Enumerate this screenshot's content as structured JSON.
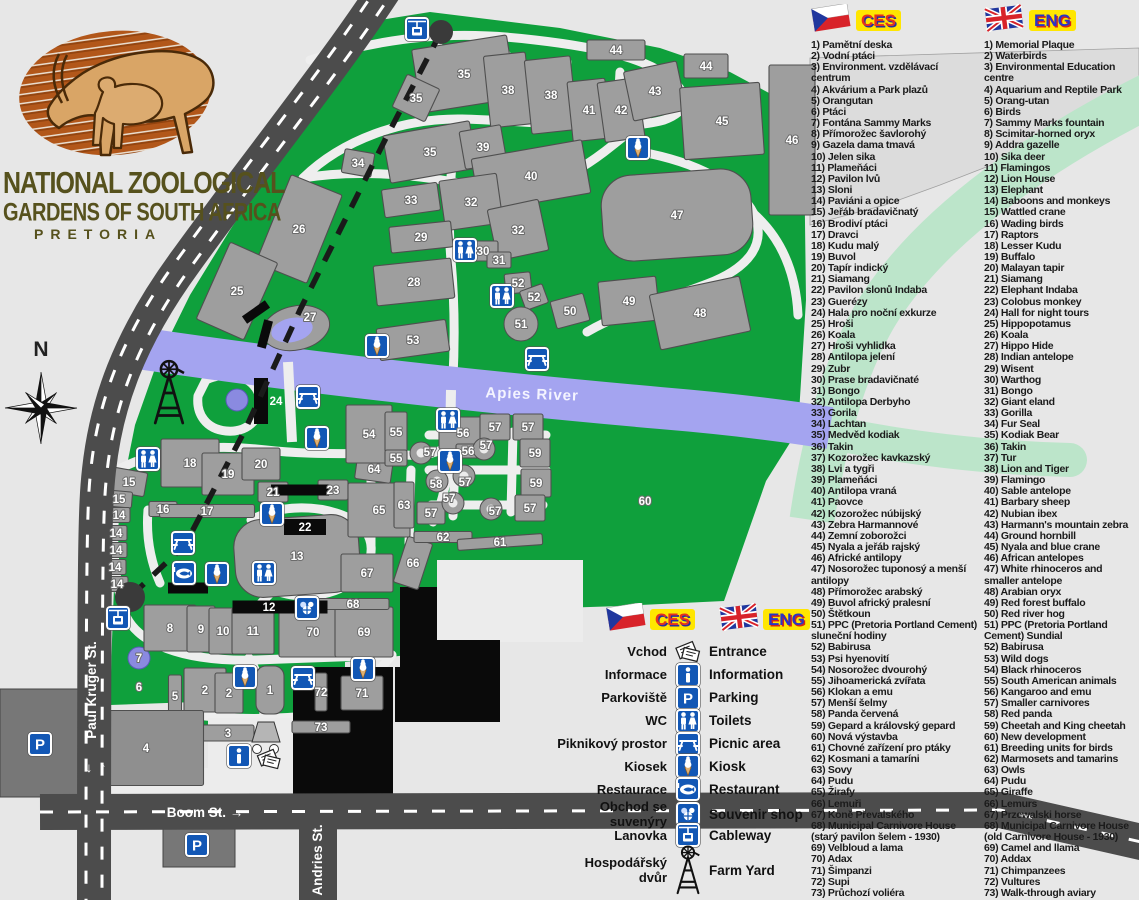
{
  "title": {
    "line1": "NATIONAL ZOOLOGICAL",
    "line2": "GARDENS OF SOUTH AFRICA",
    "line3": "PRETORIA"
  },
  "compass": {
    "label": "N"
  },
  "map": {
    "river_label": "Apies River",
    "streets": {
      "paul_kruger": "Paul Kruger St.",
      "boom": "Boom St. →",
      "andries": "Andries St.",
      "arrow_down": "↓",
      "arrow_up": "↑"
    },
    "regions": [
      {
        "n": "44",
        "x": 616,
        "y": 50,
        "w": 58,
        "h": 20
      },
      {
        "n": "44",
        "x": 706,
        "y": 66,
        "w": 44,
        "h": 24
      },
      {
        "n": "35",
        "x": 464,
        "y": 74,
        "w": 96,
        "h": 64,
        "r": -9
      },
      {
        "n": "38",
        "x": 508,
        "y": 90,
        "w": 42,
        "h": 72,
        "r": -6
      },
      {
        "n": "38",
        "x": 551,
        "y": 95,
        "w": 46,
        "h": 74,
        "r": -6
      },
      {
        "n": "41",
        "x": 589,
        "y": 110,
        "w": 38,
        "h": 60,
        "r": -6
      },
      {
        "n": "42",
        "x": 621,
        "y": 110,
        "w": 40,
        "h": 60,
        "r": -8
      },
      {
        "n": "43",
        "x": 655,
        "y": 91,
        "w": 54,
        "h": 50,
        "r": -12
      },
      {
        "n": "45",
        "x": 722,
        "y": 121,
        "w": 80,
        "h": 72,
        "r": -4
      },
      {
        "n": "46",
        "x": 792,
        "y": 140,
        "w": 46,
        "h": 150
      },
      {
        "n": "35",
        "x": 416,
        "y": 98,
        "w": 36,
        "h": 36,
        "r": 25
      },
      {
        "n": "34",
        "x": 358,
        "y": 163,
        "w": 30,
        "h": 24,
        "r": 10
      },
      {
        "n": "35",
        "x": 430,
        "y": 152,
        "w": 88,
        "h": 48,
        "r": -10
      },
      {
        "n": "39",
        "x": 483,
        "y": 147,
        "w": 42,
        "h": 38,
        "r": -10
      },
      {
        "n": "40",
        "x": 531,
        "y": 176,
        "w": 112,
        "h": 54,
        "r": -10
      },
      {
        "n": "33",
        "x": 411,
        "y": 200,
        "w": 56,
        "h": 28,
        "r": -8
      },
      {
        "n": "32",
        "x": 471,
        "y": 202,
        "w": 58,
        "h": 50,
        "r": -8
      },
      {
        "n": "32",
        "x": 518,
        "y": 230,
        "w": 52,
        "h": 52,
        "r": -12
      },
      {
        "n": "26",
        "x": 299,
        "y": 229,
        "w": 55,
        "h": 95,
        "r": 22
      },
      {
        "n": "29",
        "x": 421,
        "y": 237,
        "w": 62,
        "h": 26,
        "r": -6
      },
      {
        "n": "30",
        "x": 483,
        "y": 251,
        "w": 30,
        "h": 20
      },
      {
        "n": "31",
        "x": 499,
        "y": 260,
        "w": 24,
        "h": 16
      },
      {
        "n": "25",
        "x": 237,
        "y": 291,
        "w": 52,
        "h": 84,
        "r": 24
      },
      {
        "n": "28",
        "x": 414,
        "y": 282,
        "w": 78,
        "h": 40,
        "r": -6
      },
      {
        "n": "52",
        "x": 518,
        "y": 283,
        "w": 26,
        "h": 20,
        "r": -6
      },
      {
        "n": "52",
        "x": 534,
        "y": 297,
        "w": 24,
        "h": 20,
        "r": -20
      },
      {
        "n": "50",
        "x": 570,
        "y": 311,
        "w": 34,
        "h": 28,
        "r": -15
      },
      {
        "n": "49",
        "x": 629,
        "y": 301,
        "w": 58,
        "h": 44,
        "r": -6
      },
      {
        "n": "48",
        "x": 700,
        "y": 313,
        "w": 92,
        "h": 56,
        "r": -12
      },
      {
        "n": "47",
        "x": 677,
        "y": 215,
        "w": 150,
        "h": 86,
        "r": -4,
        "s": "blob"
      },
      {
        "n": "53",
        "x": 413,
        "y": 340,
        "w": 70,
        "h": 32,
        "r": -8
      },
      {
        "n": "18",
        "x": 190,
        "y": 463,
        "w": 58,
        "h": 48
      },
      {
        "n": "19",
        "x": 228,
        "y": 474,
        "w": 52,
        "h": 42
      },
      {
        "n": "20",
        "x": 261,
        "y": 464,
        "w": 38,
        "h": 32
      },
      {
        "n": "15",
        "x": 129,
        "y": 482,
        "w": 34,
        "h": 24,
        "r": 10
      },
      {
        "n": "15",
        "x": 119,
        "y": 499,
        "w": 26,
        "h": 16,
        "r": 5
      },
      {
        "n": "16",
        "x": 163,
        "y": 509,
        "w": 28,
        "h": 15
      },
      {
        "n": "17",
        "x": 207,
        "y": 511,
        "w": 95,
        "h": 13
      },
      {
        "n": "14",
        "x": 119,
        "y": 515,
        "w": 22,
        "h": 15
      },
      {
        "n": "14",
        "x": 116,
        "y": 533,
        "w": 22,
        "h": 15
      },
      {
        "n": "14",
        "x": 116,
        "y": 550,
        "w": 22,
        "h": 15
      },
      {
        "n": "14",
        "x": 115,
        "y": 567,
        "w": 22,
        "h": 15
      },
      {
        "n": "14",
        "x": 117,
        "y": 584,
        "w": 22,
        "h": 15
      },
      {
        "n": "21",
        "x": 273,
        "y": 492,
        "w": 30,
        "h": 20
      },
      {
        "n": "23",
        "x": 333,
        "y": 490,
        "w": 30,
        "h": 20
      },
      {
        "n": "13",
        "x": 297,
        "y": 556,
        "w": 125,
        "h": 78,
        "r": -4,
        "s": "blob"
      },
      {
        "n": "8",
        "x": 170,
        "y": 628,
        "w": 52,
        "h": 46
      },
      {
        "n": "9",
        "x": 201,
        "y": 629,
        "w": 28,
        "h": 46
      },
      {
        "n": "10",
        "x": 223,
        "y": 631,
        "w": 28,
        "h": 46
      },
      {
        "n": "11",
        "x": 253,
        "y": 631,
        "w": 42,
        "h": 46
      },
      {
        "n": "70",
        "x": 313,
        "y": 632,
        "w": 68,
        "h": 50
      },
      {
        "n": "69",
        "x": 364,
        "y": 632,
        "w": 58,
        "h": 50
      },
      {
        "n": "68",
        "x": 353,
        "y": 604,
        "w": 72,
        "h": 11
      },
      {
        "n": "67",
        "x": 367,
        "y": 573,
        "w": 52,
        "h": 38
      },
      {
        "n": "66",
        "x": 413,
        "y": 563,
        "w": 26,
        "h": 48,
        "r": 18
      },
      {
        "n": "65",
        "x": 379,
        "y": 510,
        "w": 62,
        "h": 54
      },
      {
        "n": "63",
        "x": 404,
        "y": 505,
        "w": 20,
        "h": 46
      },
      {
        "n": "64",
        "x": 374,
        "y": 469,
        "w": 36,
        "h": 24,
        "r": 8
      },
      {
        "n": "62",
        "x": 443,
        "y": 537,
        "w": 58,
        "h": 11
      },
      {
        "n": "61",
        "x": 500,
        "y": 542,
        "w": 85,
        "h": 11,
        "r": -4
      },
      {
        "n": "54",
        "x": 369,
        "y": 434,
        "w": 46,
        "h": 58
      },
      {
        "n": "55",
        "x": 396,
        "y": 432,
        "w": 22,
        "h": 40
      },
      {
        "n": "55",
        "x": 396,
        "y": 458,
        "w": 22,
        "h": 16
      },
      {
        "n": "56",
        "x": 463,
        "y": 433,
        "w": 48,
        "h": 32
      },
      {
        "n": "56",
        "x": 468,
        "y": 451,
        "w": 24,
        "h": 14
      },
      {
        "n": "57",
        "x": 495,
        "y": 427,
        "w": 30,
        "h": 26
      },
      {
        "n": "57",
        "x": 528,
        "y": 427,
        "w": 30,
        "h": 26
      },
      {
        "n": "59",
        "x": 535,
        "y": 453,
        "w": 30,
        "h": 28
      },
      {
        "n": "59",
        "x": 536,
        "y": 483,
        "w": 30,
        "h": 28
      },
      {
        "n": "57",
        "x": 431,
        "y": 513,
        "w": 28,
        "h": 22
      },
      {
        "n": "57",
        "x": 530,
        "y": 508,
        "w": 30,
        "h": 26
      },
      {
        "n": "71",
        "x": 362,
        "y": 693,
        "w": 42,
        "h": 34
      },
      {
        "n": "72",
        "x": 321,
        "y": 692,
        "w": 12,
        "h": 38
      },
      {
        "n": "73",
        "x": 321,
        "y": 727,
        "w": 58,
        "h": 12
      },
      {
        "n": "1",
        "x": 270,
        "y": 690,
        "w": 28,
        "h": 48,
        "s": "blob"
      },
      {
        "n": "2",
        "x": 205,
        "y": 690,
        "w": 42,
        "h": 44
      },
      {
        "n": "2",
        "x": 229,
        "y": 693,
        "w": 28,
        "h": 40
      },
      {
        "n": "3",
        "x": 228,
        "y": 733,
        "w": 52,
        "h": 16
      },
      {
        "n": "5",
        "x": 175,
        "y": 696,
        "w": 13,
        "h": 42
      },
      {
        "n": "4",
        "x": 146,
        "y": 748,
        "w": 115,
        "h": 75,
        "f": "#8f8f8f"
      }
    ],
    "labels_extra": [
      {
        "n": "57",
        "x": 430,
        "y": 452
      },
      {
        "n": "57",
        "x": 486,
        "y": 445
      },
      {
        "n": "57",
        "x": 465,
        "y": 482
      },
      {
        "n": "57",
        "x": 449,
        "y": 498
      },
      {
        "n": "57",
        "x": 495,
        "y": 511
      },
      {
        "n": "58",
        "x": 436,
        "y": 484
      },
      {
        "n": "60",
        "x": 645,
        "y": 501
      },
      {
        "n": "6",
        "x": 139,
        "y": 687
      },
      {
        "n": "27",
        "x": 310,
        "y": 317
      },
      {
        "n": "7",
        "x": 139,
        "y": 658
      },
      {
        "n": "51",
        "x": 521,
        "y": 324
      }
    ],
    "black_labeled": [
      {
        "n": "22",
        "x": 305,
        "y": 527,
        "w": 42,
        "h": 16
      },
      {
        "n": "12",
        "x": 280,
        "y": 607,
        "w": 95,
        "h": 13,
        "lx": 269
      },
      {
        "n": "24",
        "x": 261,
        "y": 401,
        "w": 14,
        "h": 46,
        "lx": 276
      }
    ],
    "icons": [
      {
        "t": "cableway",
        "x": 417,
        "y": 29
      },
      {
        "t": "cableway",
        "x": 118,
        "y": 618
      },
      {
        "t": "kiosk",
        "x": 638,
        "y": 148
      },
      {
        "t": "kiosk",
        "x": 377,
        "y": 346
      },
      {
        "t": "kiosk",
        "x": 317,
        "y": 438
      },
      {
        "t": "kiosk",
        "x": 272,
        "y": 514
      },
      {
        "t": "kiosk",
        "x": 217,
        "y": 574
      },
      {
        "t": "kiosk",
        "x": 450,
        "y": 461
      },
      {
        "t": "kiosk",
        "x": 245,
        "y": 677
      },
      {
        "t": "kiosk",
        "x": 363,
        "y": 669
      },
      {
        "t": "wc",
        "x": 465,
        "y": 250
      },
      {
        "t": "wc",
        "x": 502,
        "y": 296
      },
      {
        "t": "wc",
        "x": 448,
        "y": 420
      },
      {
        "t": "wc",
        "x": 148,
        "y": 459
      },
      {
        "t": "wc",
        "x": 264,
        "y": 573
      },
      {
        "t": "picnic",
        "x": 308,
        "y": 397
      },
      {
        "t": "picnic",
        "x": 537,
        "y": 359
      },
      {
        "t": "picnic",
        "x": 183,
        "y": 543
      },
      {
        "t": "picnic",
        "x": 303,
        "y": 678
      },
      {
        "t": "restaurant",
        "x": 184,
        "y": 573
      },
      {
        "t": "souvenir",
        "x": 307,
        "y": 608
      },
      {
        "t": "info",
        "x": 239,
        "y": 756
      },
      {
        "t": "entrance",
        "x": 268,
        "y": 758
      },
      {
        "t": "parking",
        "x": 40,
        "y": 744
      },
      {
        "t": "parking",
        "x": 197,
        "y": 845
      },
      {
        "t": "farmyard",
        "x": 169,
        "y": 398
      }
    ]
  },
  "legend_cs": {
    "header": "CES",
    "items": [
      "1) Pamětní deska",
      "2) Vodní ptáci",
      "3) Environment. vzdělávací centrum",
      "4) Akvárium a Park plazů",
      "5) Orangutan",
      "6) Ptáci",
      "7) Fontána Sammy Marks",
      "8) Přímorožec šavlorohý",
      "9) Gazela dama tmavá",
      "10) Jelen sika",
      "11) Plameňáci",
      "12) Pavilon lvů",
      "13) Sloni",
      "14) Paviáni a opice",
      "15) Jeřáb bradavičnatý",
      "16) Brodiví ptáci",
      "17) Dravci",
      "18) Kudu malý",
      "19) Buvol",
      "20) Tapír indický",
      "21) Siamang",
      "22) Pavilon slonů Indaba",
      "23) Guerézy",
      "24) Hala pro noční exkurze",
      "25) Hroši",
      "26) Koala",
      "27) Hroši vyhlidka",
      "28) Antilopa jelení",
      "29) Zubr",
      "30) Prase bradavičnaté",
      "31) Bongo",
      "32) Antilopa Derbyho",
      "33) Gorila",
      "34) Lachtan",
      "35) Medvěd kodiak",
      "36) Takin",
      "37) Kozorožec kavkazský",
      "38) Lvi a tygři",
      "39) Plameňáci",
      "40) Antilopa vraná",
      "41) Paovce",
      "42) Kozorožec núbijský",
      "43) Zebra Harmannové",
      "44) Zemní zoborožci",
      "45) Nyala a jeřáb rajský",
      "46) Africké antilopy",
      "47) Nosorožec tuponosý a menší antilopy",
      "48) Přímorožec arabský",
      "49) Buvol africký pralesní",
      "50) Štětkoun",
      "51) PPC (Pretoria Portland Cement) sluneční hodiny",
      "52) Babirusa",
      "53) Psi hyenovití",
      "54) Nosorožec dvourohý",
      "55) Jihoamerická zvířata",
      "56) Klokan a emu",
      "57) Menší šelmy",
      "58) Panda červená",
      "59) Gepard a královský gepard",
      "60) Nová výstavba",
      "61) Chovné zařízení pro ptáky",
      "62) Kosmani a tamaríni",
      "63) Sovy",
      "64) Pudu",
      "65) Žirafy",
      "66) Lemuři",
      "67) Koně Převalského",
      "68) Municipal Carnivore House (starý pavilon šelem - 1930)",
      "69) Velbloud a lama",
      "70) Adax",
      "71) Šimpanzi",
      "72) Supi",
      "73) Průchozí voliéra"
    ]
  },
  "legend_en": {
    "header": "ENG",
    "items": [
      "1) Memorial Plaque",
      "2) Waterbirds",
      "3) Environmental Education centre",
      "4) Aquarium and Reptile Park",
      "5) Orang-utan",
      "6) Birds",
      "7) Sammy Marks fountain",
      "8) Scimitar-horned oryx",
      "9) Addra gazelle",
      "10) Sika deer",
      "11) Flamingos",
      "12) Lion House",
      "13) Elephant",
      "14) Baboons and monkeys",
      "15) Wattled crane",
      "16) Wading birds",
      "17) Raptors",
      "18) Lesser Kudu",
      "19) Buffalo",
      "20) Malayan tapir",
      "21) Siamang",
      "22) Elephant Indaba",
      "23) Colobus monkey",
      "24) Hall for night tours",
      "25) Hippopotamus",
      "26) Koala",
      "27) Hippo Hide",
      "28) Indian antelope",
      "29) Wisent",
      "30) Warthog",
      "31) Bongo",
      "32) Giant eland",
      "33) Gorilla",
      "34) Fur Seal",
      "35) Kodiak Bear",
      "36) Takin",
      "37) Tur",
      "38) Lion and Tiger",
      "39) Flamingo",
      "40) Sable antelope",
      "41) Barbary sheep",
      "42) Nubian ibex",
      "43) Harmann's mountain zebra",
      "44) Ground hornbill",
      "45) Nyala and blue crane",
      "46) African antelopes",
      "47) White rhinoceros and smaller antelope",
      "48) Arabian oryx",
      "49) Red forest buffalo",
      "50) Red river hog",
      "51) PPC (Pretoria Portland Cement) Sundial",
      "52) Babirusa",
      "53) Wild dogs",
      "54) Black rhinoceros",
      "55) South American animals",
      "56) Kangaroo and emu",
      "57) Smaller carnivores",
      "58) Red panda",
      "59) Cheetah and King cheetah",
      "60) New development",
      "61) Breeding units for birds",
      "62) Marmosets and tamarins",
      "63) Owls",
      "64) Pudu",
      "65) Giraffe",
      "66) Lemurs",
      "67) Przewalski horse",
      "68) Municipal Carnivore House (old Carnivore House - 1930)",
      "69) Camel and llama",
      "70) Addax",
      "71) Chimpanzees",
      "72) Vultures",
      "73) Walk-through aviary"
    ]
  },
  "legend_key": {
    "ces": "CES",
    "eng": "ENG",
    "rows": [
      {
        "cs": "Vchod",
        "icon": "entrance",
        "en": "Entrance"
      },
      {
        "cs": "Informace",
        "icon": "info",
        "en": "Information"
      },
      {
        "cs": "Parkoviště",
        "icon": "parking",
        "en": "Parking"
      },
      {
        "cs": "WC",
        "icon": "wc",
        "en": "Toilets"
      },
      {
        "cs": "Piknikový prostor",
        "icon": "picnic",
        "en": "Picnic area"
      },
      {
        "cs": "Kiosek",
        "icon": "kiosk",
        "en": "Kiosk"
      },
      {
        "cs": "Restaurace",
        "icon": "restaurant",
        "en": "Restaurant"
      },
      {
        "cs": "Obchod se suvenýry",
        "icon": "souvenir",
        "en": "Souvenir shop"
      },
      {
        "cs": "Lanovka",
        "icon": "cableway",
        "en": "Cableway"
      },
      {
        "cs": "Hospodářský dvůr",
        "icon": "farmyard",
        "en": "Farm Yard"
      }
    ]
  },
  "colors": {
    "park_green": "#0fa03c",
    "river": "#a4a4f0",
    "road": "#4c4c4c",
    "icon_blue": "#1257b5",
    "pale_band": "#bce5ca"
  }
}
